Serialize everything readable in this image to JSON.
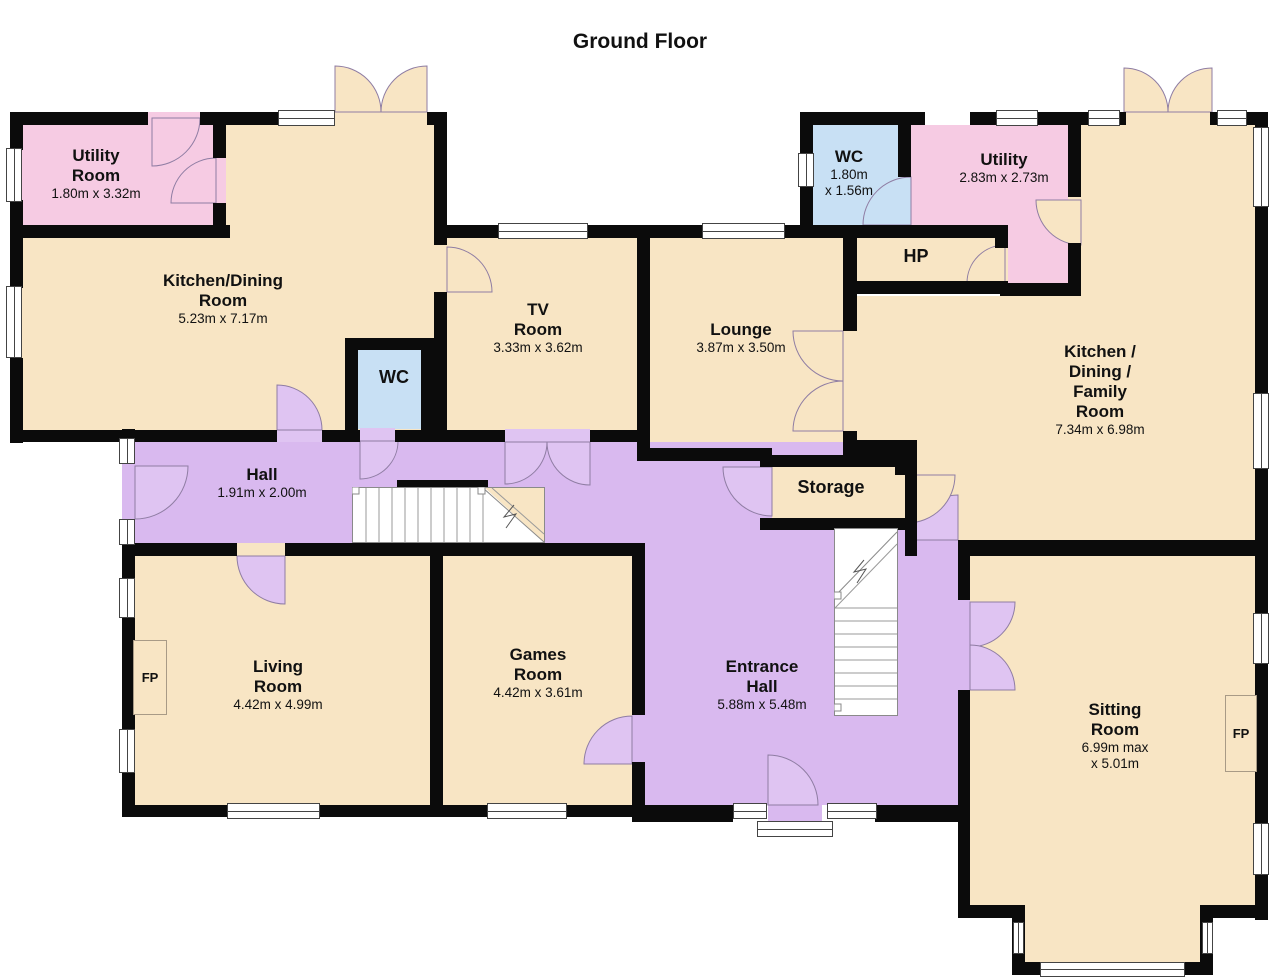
{
  "title": "Ground Floor",
  "rooms": {
    "utility_left": {
      "name": "Utility\nRoom",
      "dims": "1.80m x 3.32m"
    },
    "kitchen_dining": {
      "name": "Kitchen/Dining\nRoom",
      "dims": "5.23m x 7.17m"
    },
    "tv": {
      "name": "TV\nRoom",
      "dims": "3.33m x 3.62m"
    },
    "wc_small": {
      "name": "WC"
    },
    "lounge": {
      "name": "Lounge",
      "dims": "3.87m x 3.50m"
    },
    "wc_top": {
      "name": "WC",
      "dims": "1.80m\nx 1.56m"
    },
    "utility_right": {
      "name": "Utility",
      "dims": "2.83m x 2.73m"
    },
    "hp": {
      "name": "HP"
    },
    "kitchen_family": {
      "name": "Kitchen /\nDining /\nFamily\nRoom",
      "dims": "7.34m x 6.98m"
    },
    "hall": {
      "name": "Hall",
      "dims": "1.91m x 2.00m"
    },
    "storage": {
      "name": "Storage"
    },
    "living": {
      "name": "Living\nRoom",
      "dims": "4.42m x 4.99m"
    },
    "games": {
      "name": "Games\nRoom",
      "dims": "4.42m x 3.61m"
    },
    "entrance": {
      "name": "Entrance\nHall",
      "dims": "5.88m x 5.48m"
    },
    "sitting": {
      "name": "Sitting\nRoom",
      "dims": "6.99m max\nx 5.01m"
    },
    "fireplace": {
      "label": "FP"
    }
  },
  "colors": {
    "cream": "#f8e5c4",
    "pink": "#f6cbe3",
    "blue": "#c8e0f4",
    "purple": "#d9b9ef",
    "swing_purple": "#dfc4f2",
    "wall": "#0b0b0b"
  }
}
